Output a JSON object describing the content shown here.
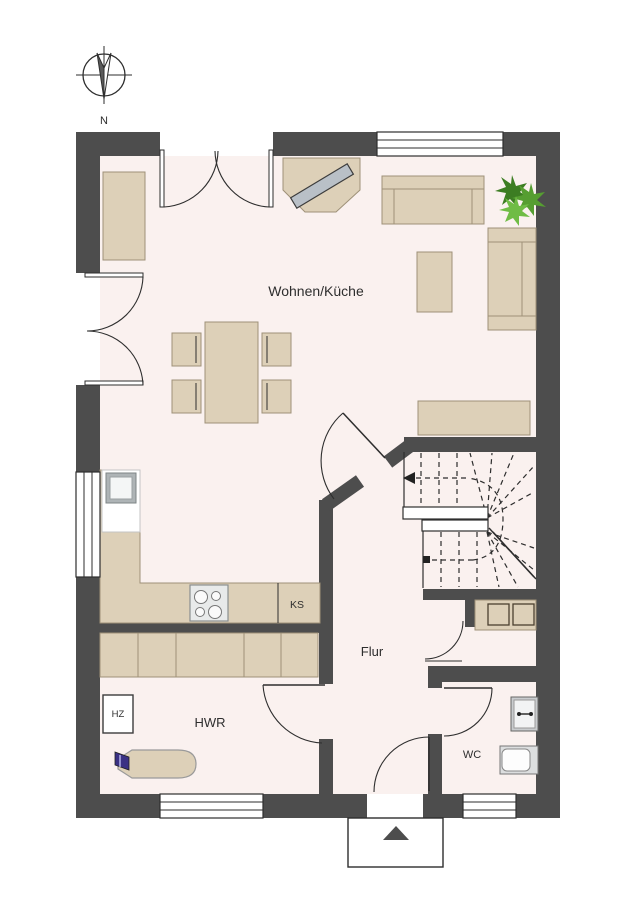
{
  "plan": {
    "type": "floorplan",
    "labels": {
      "compass_north": "N",
      "living_kitchen": "Wohnen/Küche",
      "hall": "Flur",
      "utility_room": "HWR",
      "wc": "WC",
      "fridge": "KS",
      "heater": "HZ"
    },
    "rooms": [
      {
        "name": "Wohnen/Küche"
      },
      {
        "name": "Flur"
      },
      {
        "name": "HWR"
      },
      {
        "name": "WC"
      }
    ],
    "furniture_icons": [
      "sideboard-icon",
      "tv-corner-unit-icon",
      "sofa-icon",
      "plant-icon",
      "coffee-table-icon",
      "dining-table-icon",
      "chair-icon",
      "kitchen-counter-icon",
      "sink-icon",
      "cooktop-icon",
      "fridge-icon",
      "cabinet-row-icon",
      "stairs-icon",
      "understair-cabinet-icon",
      "heater-icon",
      "ironing-board-icon",
      "iron-icon",
      "wc-sink-icon",
      "toilet-icon",
      "entrance-arrow-icon",
      "compass-icon",
      "window-icon",
      "door-icon"
    ],
    "colors": {
      "background": "#ffffff",
      "wall": "#4d4d4d",
      "floor": "#faf1ef",
      "furniture": "#ddd0b8",
      "furniture_border": "#9e9178",
      "tv_gray": "#b9c0c7",
      "plant_green": "#569e31",
      "plant_green_dark": "#3c7d22",
      "plant_green_light": "#6fbc45",
      "iron_blue": "#3a3184"
    }
  }
}
